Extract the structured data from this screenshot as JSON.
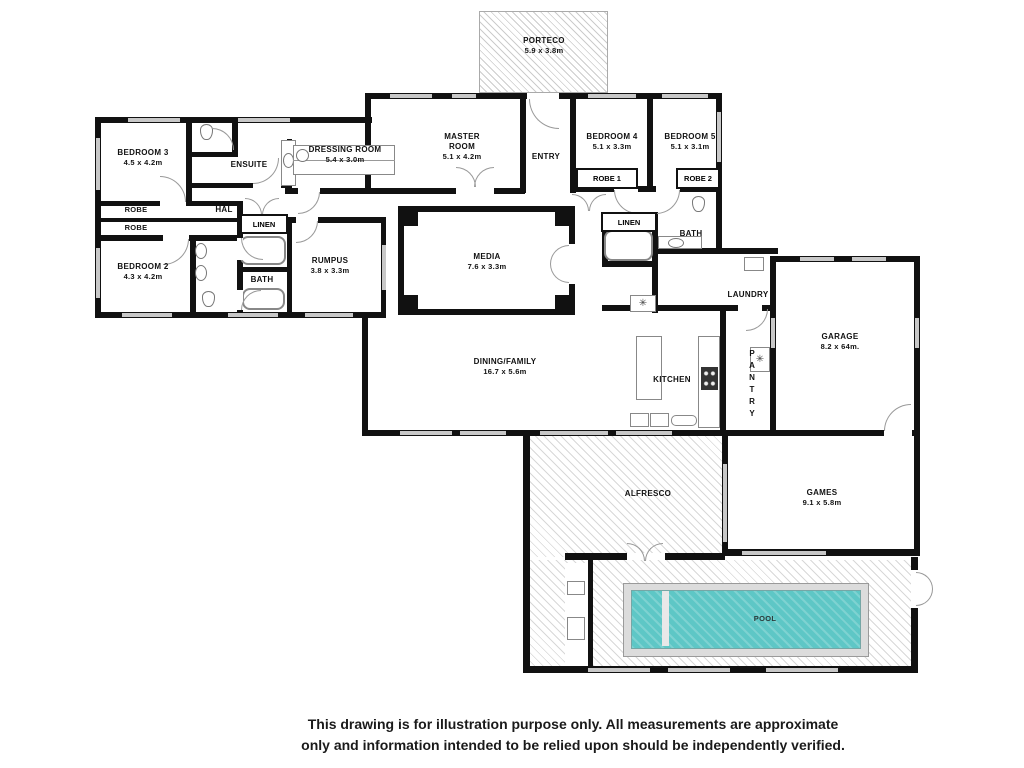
{
  "rooms": {
    "porteco": {
      "name": "PORTECO",
      "dims": "5.9 x 3.8m"
    },
    "bedroom3": {
      "name": "BEDROOM 3",
      "dims": "4.5 x 4.2m"
    },
    "ensuite": {
      "name": "ENSUITE"
    },
    "dressing_room": {
      "name": "DRESSING ROOM",
      "dims": "5.4 x 3.0m"
    },
    "master": {
      "l1": "MASTER",
      "l2": "ROOM",
      "dims": "5.1 x 4.2m"
    },
    "entry": {
      "name": "ENTRY"
    },
    "bedroom4": {
      "name": "BEDROOM 4",
      "dims": "5.1 x 3.3m"
    },
    "bedroom5": {
      "name": "BEDROOM 5",
      "dims": "5.1 x 3.1m"
    },
    "robe1": {
      "name": "ROBE 1"
    },
    "robe2": {
      "name": "ROBE 2"
    },
    "robe_upper": {
      "name": "ROBE"
    },
    "robe_lower": {
      "name": "ROBE"
    },
    "hall": {
      "name": "HAL"
    },
    "linen_left": {
      "name": "LINEN"
    },
    "bedroom2": {
      "name": "BEDROOM 2",
      "dims": "4.3 x 4.2m"
    },
    "bath_left": {
      "name": "BATH"
    },
    "rumpus": {
      "name": "RUMPUS",
      "dims": "3.8 x 3.3m"
    },
    "media": {
      "name": "MEDIA",
      "dims": "7.6 x 3.3m"
    },
    "linen_right": {
      "name": "LINEN"
    },
    "bath_right": {
      "name": "BATH"
    },
    "laundry": {
      "name": "LAUNDRY"
    },
    "garage": {
      "name": "GARAGE",
      "dims": "8.2 x 64m."
    },
    "dining_family": {
      "name": "DINING/FAMILY",
      "dims": "16.7 x 5.6m"
    },
    "kitchen": {
      "name": "KITCHEN"
    },
    "pantry": {
      "name": "PANTRY"
    },
    "alfresco": {
      "name": "ALFRESCO"
    },
    "games": {
      "name": "GAMES",
      "dims": "9.1 x 5.8m"
    },
    "pool": {
      "name": "POOL"
    }
  },
  "icons": {
    "washer_glyph": "✳",
    "freezer_glyph": "✳"
  },
  "colors": {
    "wall": "#111111",
    "pool_water": "#5ec7c6",
    "pool_surround": "#dcdcdc",
    "hatch_line": "#cccccc"
  },
  "disclaimer": {
    "line1": "This drawing is for illustration purpose only. All measurements are approximate",
    "line2": "only and information intended to be relied upon should be independently verified."
  }
}
